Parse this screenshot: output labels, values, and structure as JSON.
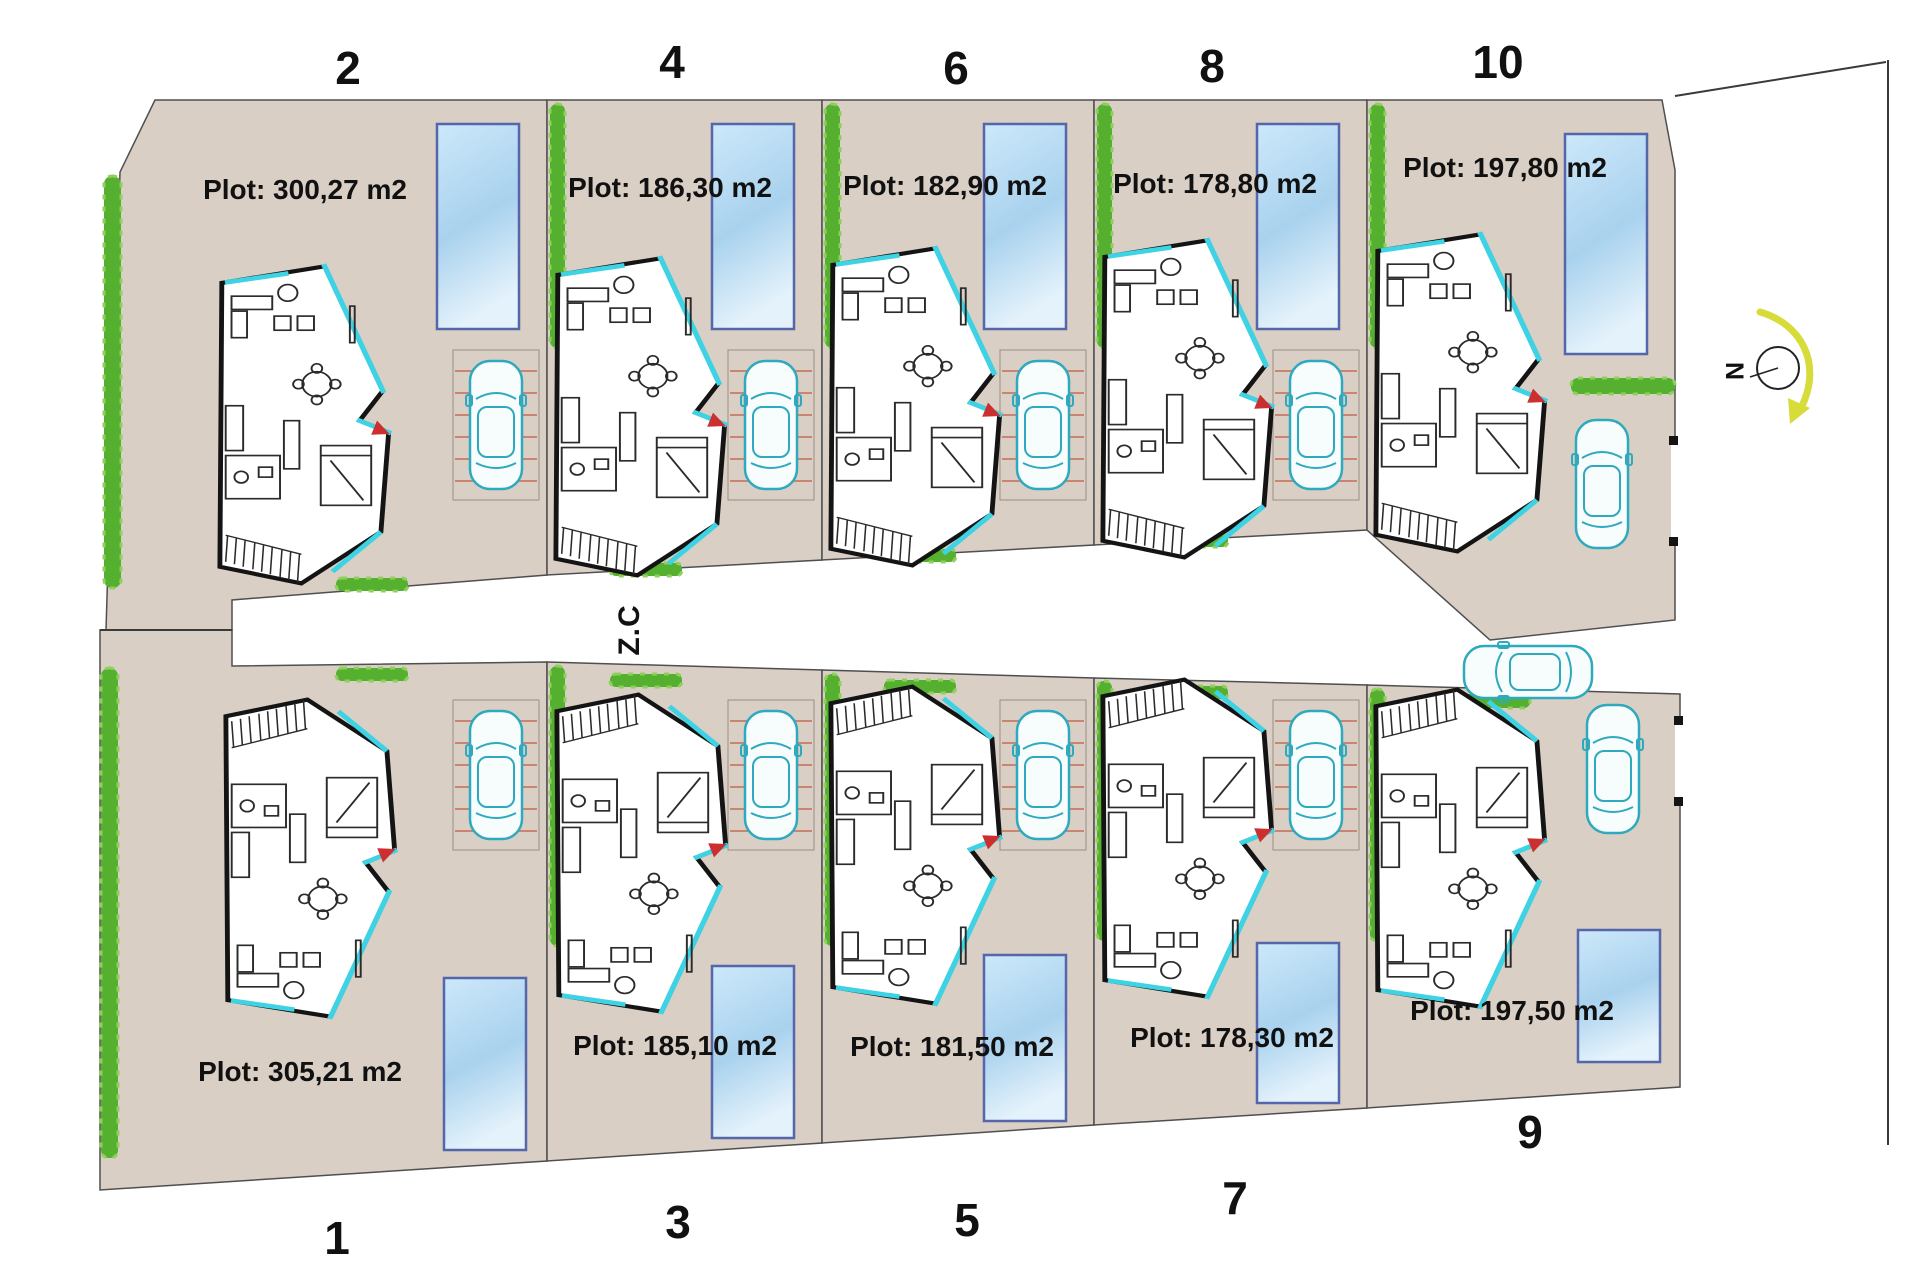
{
  "plots": [
    {
      "number": "1",
      "area": "Plot: 305,21 m2"
    },
    {
      "number": "2",
      "area": "Plot: 300,27 m2"
    },
    {
      "number": "3",
      "area": "Plot: 185,10 m2"
    },
    {
      "number": "4",
      "area": "Plot: 186,30 m2"
    },
    {
      "number": "5",
      "area": "Plot: 181,50 m2"
    },
    {
      "number": "6",
      "area": "Plot: 182,90 m2"
    },
    {
      "number": "7",
      "area": "Plot: 178,30 m2"
    },
    {
      "number": "8",
      "area": "Plot: 178,80 m2"
    },
    {
      "number": "9",
      "area": "Plot: 197,50 m2"
    },
    {
      "number": "10",
      "area": "Plot: 197,80 m2"
    }
  ],
  "road": {
    "label": "Z.C"
  },
  "compass": {
    "label": "N"
  },
  "colors": {
    "plot_fill": "#d9cfc5",
    "pool_blue": "#a9d2ee",
    "hedge_green": "#54b02e",
    "glass_cyan": "#3ed3e4",
    "stripe_red": "#c98472",
    "north_arrow_yellow": "#d8dc3a"
  }
}
